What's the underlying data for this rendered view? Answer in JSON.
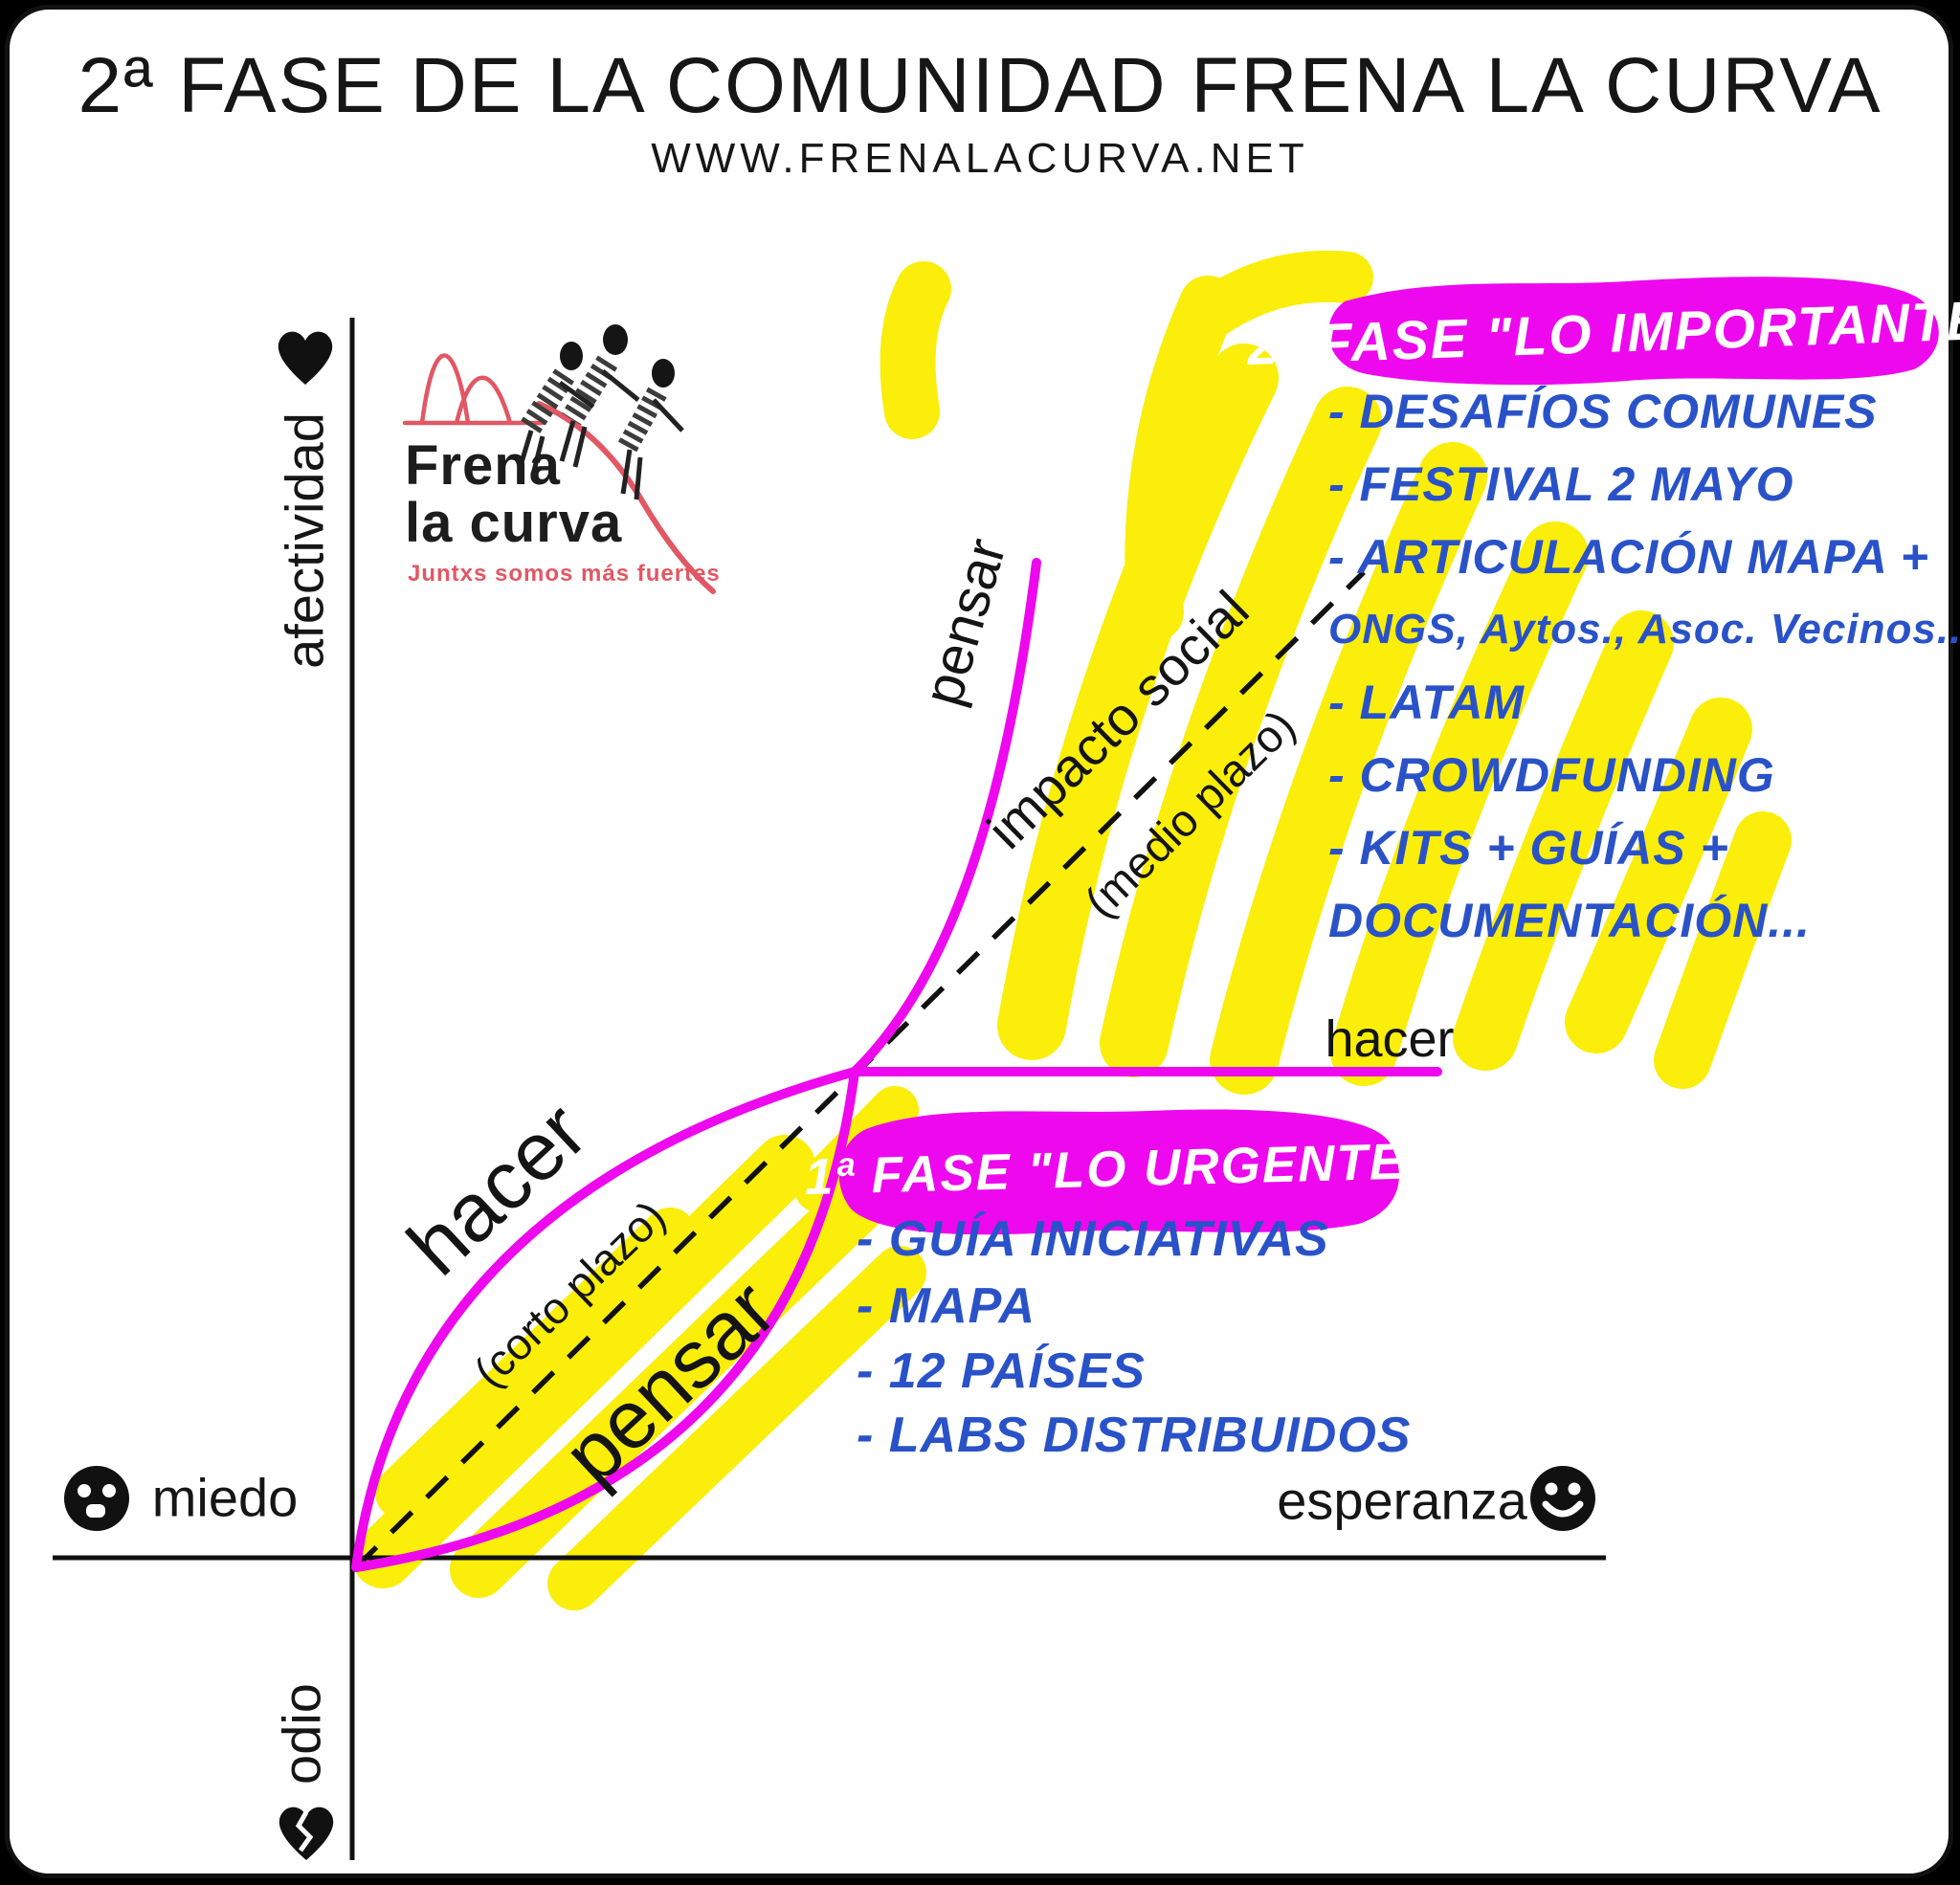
{
  "header": {
    "title": "2ª FASE DE LA COMUNIDAD FRENA LA CURVA",
    "subtitle": "WWW.FRENALACURVA.NET"
  },
  "logo": {
    "name_line1": "Frena",
    "name_line2": "la curva",
    "tagline": "Juntxs somos más fuertes"
  },
  "axes": {
    "y_positive": "afectividad",
    "y_negative": "odio",
    "x_negative": "miedo",
    "x_positive": "esperanza"
  },
  "icons": {
    "y_positive": "heart-icon",
    "y_negative": "broken-heart-icon",
    "x_negative": "fearful-face-icon",
    "x_positive": "smiley-face-icon"
  },
  "curve": {
    "hacer_lower": "hacer",
    "pensar_lower": "pensar",
    "corto_plazo": "(corto plazo)",
    "pensar_upper": "pensar",
    "hacer_upper": "hacer",
    "impacto_social": "impacto social",
    "medio_plazo": "(medio plazo)"
  },
  "phase2": {
    "title": "2ª FASE \"LO IMPORTANTE\"",
    "items": [
      "- DESAFÍOS COMUNES",
      "- FESTIVAL 2 MAYO",
      "- ARTICULACIÓN MAPA +",
      "ONGS, Aytos., Asoc. Vecinos...",
      "- LATAM",
      "- CROWDFUNDING",
      "- KITS + GUÍAS +",
      "DOCUMENTACIÓN..."
    ]
  },
  "phase1": {
    "title": "1ª FASE \"LO URGENTE\"",
    "items": [
      "- GUÍA INICIATIVAS",
      "- MAPA",
      "- 12 PAÍSES",
      "- LABS DISTRIBUIDOS"
    ]
  },
  "colors": {
    "magenta": "#ee08ee",
    "yellow": "#faee0a",
    "blue": "#2a52c8",
    "logo_red": "#e25764",
    "ink": "#111111"
  }
}
